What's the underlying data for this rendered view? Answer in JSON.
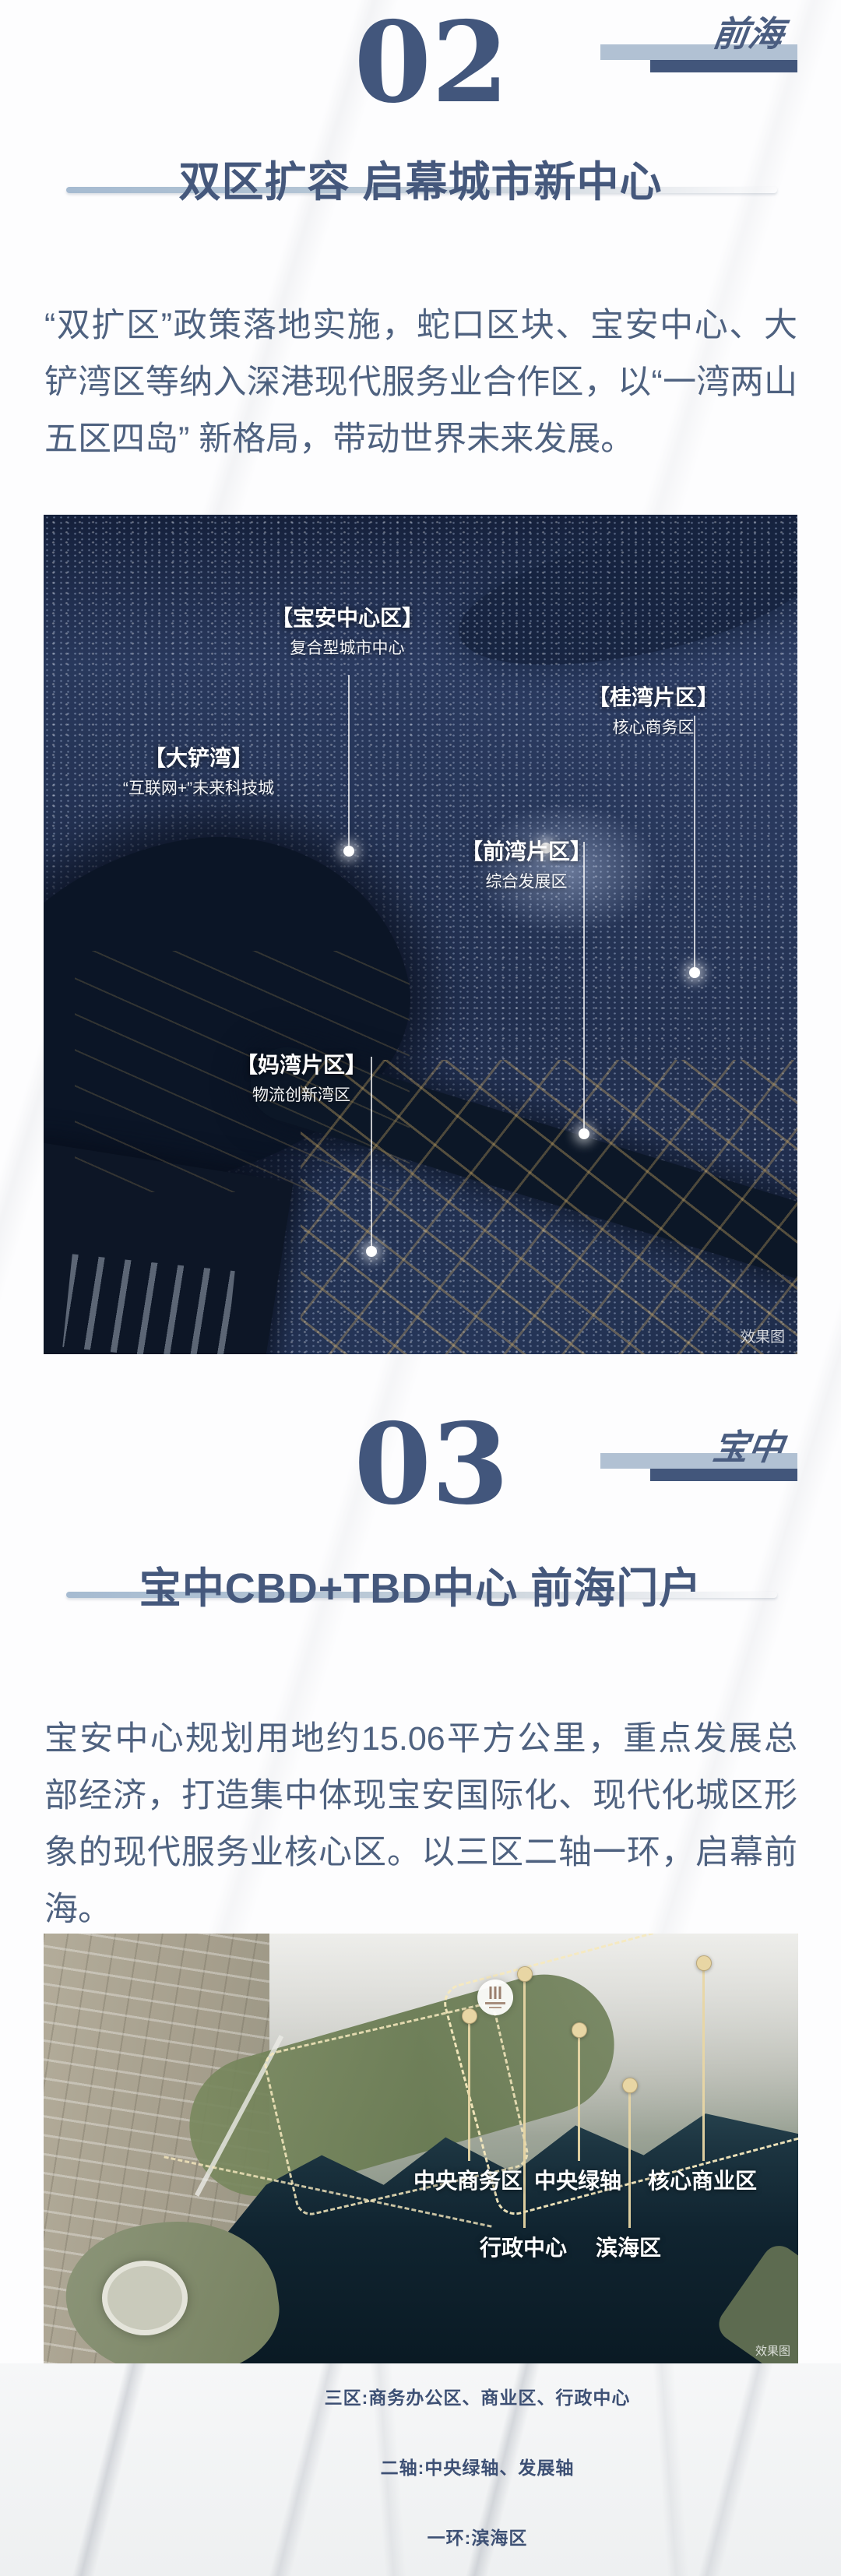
{
  "colors": {
    "accent_dark": "#44587c",
    "light_bar": "#b1c1d3",
    "dark_bar": "#42567b",
    "body_text": "#4f6280",
    "note_text": "#3d5074",
    "leader_beige": "#e8d6a4"
  },
  "section2": {
    "number": "02",
    "tag": "前海",
    "title": "双区扩容 启幕城市新中心",
    "paragraph": "“双扩区”政策落地实施，蛇口区块、宝安中心、大铲湾区等纳入深港现代服务业合作区，以“一湾两山五区四岛” 新格局，带动世界未来发展。",
    "photo": {
      "watermark": "效果图",
      "labels": [
        {
          "name": "【宝安中心区】",
          "desc": "复合型城市中心"
        },
        {
          "name": "【桂湾片区】",
          "desc": "核心商务区"
        },
        {
          "name": "【大铲湾】",
          "desc": "“互联网+”未来科技城"
        },
        {
          "name": "【前湾片区】",
          "desc": "综合发展区"
        },
        {
          "name": "【妈湾片区】",
          "desc": "物流创新湾区"
        }
      ]
    }
  },
  "section3": {
    "number": "03",
    "tag": "宝中",
    "title": "宝中CBD+TBD中心 前海门户",
    "paragraph": "宝安中心规划用地约15.06平方公里，重点发展总部经济，打造集中体现宝安国际化、现代化城区形象的现代服务业核心区。以三区二轴一环，启幕前海。",
    "photo": {
      "watermark": "效果图",
      "labels": [
        {
          "name": "中央商务区"
        },
        {
          "name": "中央绿轴"
        },
        {
          "name": "核心商业区"
        },
        {
          "name": "行政中心"
        },
        {
          "name": "滨海区"
        }
      ]
    },
    "notes": [
      "三区:商务办公区、商业区、行政中心",
      "二轴:中央绿轴、发展轴",
      "一环:滨海区"
    ]
  }
}
